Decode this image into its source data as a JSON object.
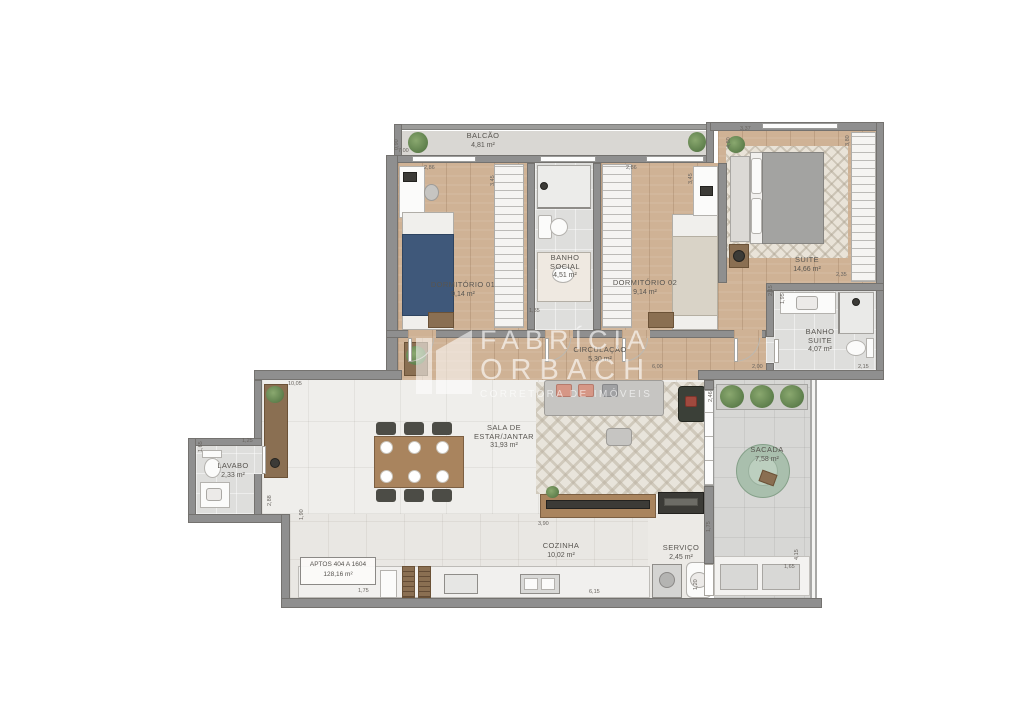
{
  "watermark": {
    "line1": "FABRÍCIA",
    "line2": "ORBACH",
    "tagline": "CORRETORA DE IMÓVEIS"
  },
  "unit_box": {
    "line1": "APTOS 404 A 1604",
    "line2": "128,16 m²"
  },
  "rooms": {
    "balcao": {
      "name": "BALCÃO",
      "area": "4,81 m²"
    },
    "dormitorio1": {
      "name": "DORMITÓRIO 01",
      "area": "9,14 m²"
    },
    "banho_social": {
      "name": "BANHO\nSOCIAL",
      "area": "4,51 m²"
    },
    "dormitorio2": {
      "name": "DORMITÓRIO 02",
      "area": "9,14 m²"
    },
    "suite": {
      "name": "SUITE",
      "area": "14,66 m²"
    },
    "banho_suite": {
      "name": "BANHO\nSUITE",
      "area": "4,07 m²"
    },
    "circulacao": {
      "name": "CIRCULAÇÃO",
      "area": "5,30 m²"
    },
    "sala": {
      "name": "SALA DE\nESTAR/JANTAR",
      "area": "31,93 m²"
    },
    "lavabo": {
      "name": "LAVABO",
      "area": "2,33 m²"
    },
    "sacada": {
      "name": "SACADA",
      "area": "7,58 m²"
    },
    "cozinha": {
      "name": "COZINHA",
      "area": "10,02 m²"
    },
    "servico": {
      "name": "SERVIÇO",
      "area": "2,45 m²"
    }
  },
  "dims": [
    "0,90",
    "7,00",
    "2,86",
    "3,45",
    "2,86",
    "3,45",
    "4,80",
    "3,37",
    "3,80",
    "2,35",
    "2,15",
    "1,95",
    "2,00",
    "2,15",
    "6,00",
    "2,46",
    "1,35",
    "10,05",
    "1,25",
    "1,65",
    "2,88",
    "1,90",
    "3,90",
    "1,75",
    "6,15",
    "1,20",
    "4,15",
    "1,65",
    "1,75"
  ],
  "colors": {
    "wall": "#8f8f8f",
    "wood_floor": "#cfb295",
    "tile_floor": "#efeeeb",
    "bed1_cover": "#3f587a",
    "bed2_cover": "#d9d3c7",
    "egg_chair": "#a9bfad",
    "plant": "#5e7f4c",
    "accent_pillow": "#d69786"
  }
}
